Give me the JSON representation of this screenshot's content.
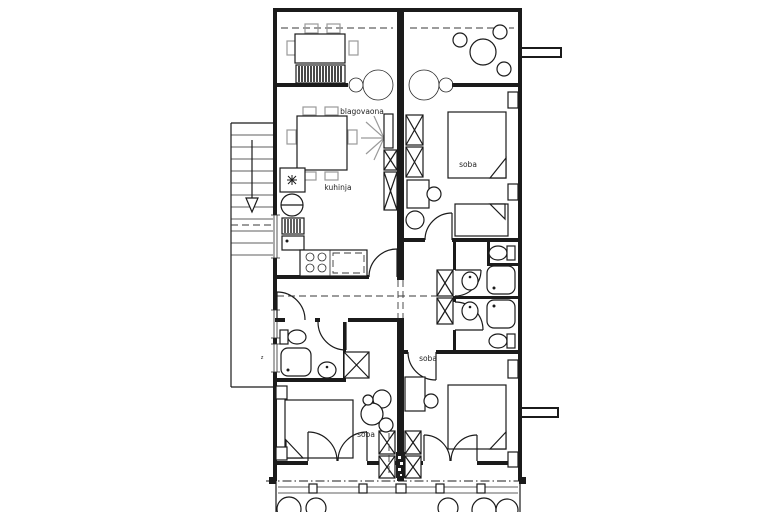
{
  "plan": {
    "rooms": {
      "dining": "blagovaona",
      "kitchen": "kuhinja",
      "bedroom_upper_right": "soba",
      "bedroom_lower_right": "soba",
      "bedroom_lower_left": "soba"
    },
    "wall_annotation": "z",
    "colors": {
      "background": "#ffffff",
      "line": "#1b1b1b",
      "furniture_gray": "#9a9a9a",
      "dash_line": "#3a3a3a"
    }
  }
}
